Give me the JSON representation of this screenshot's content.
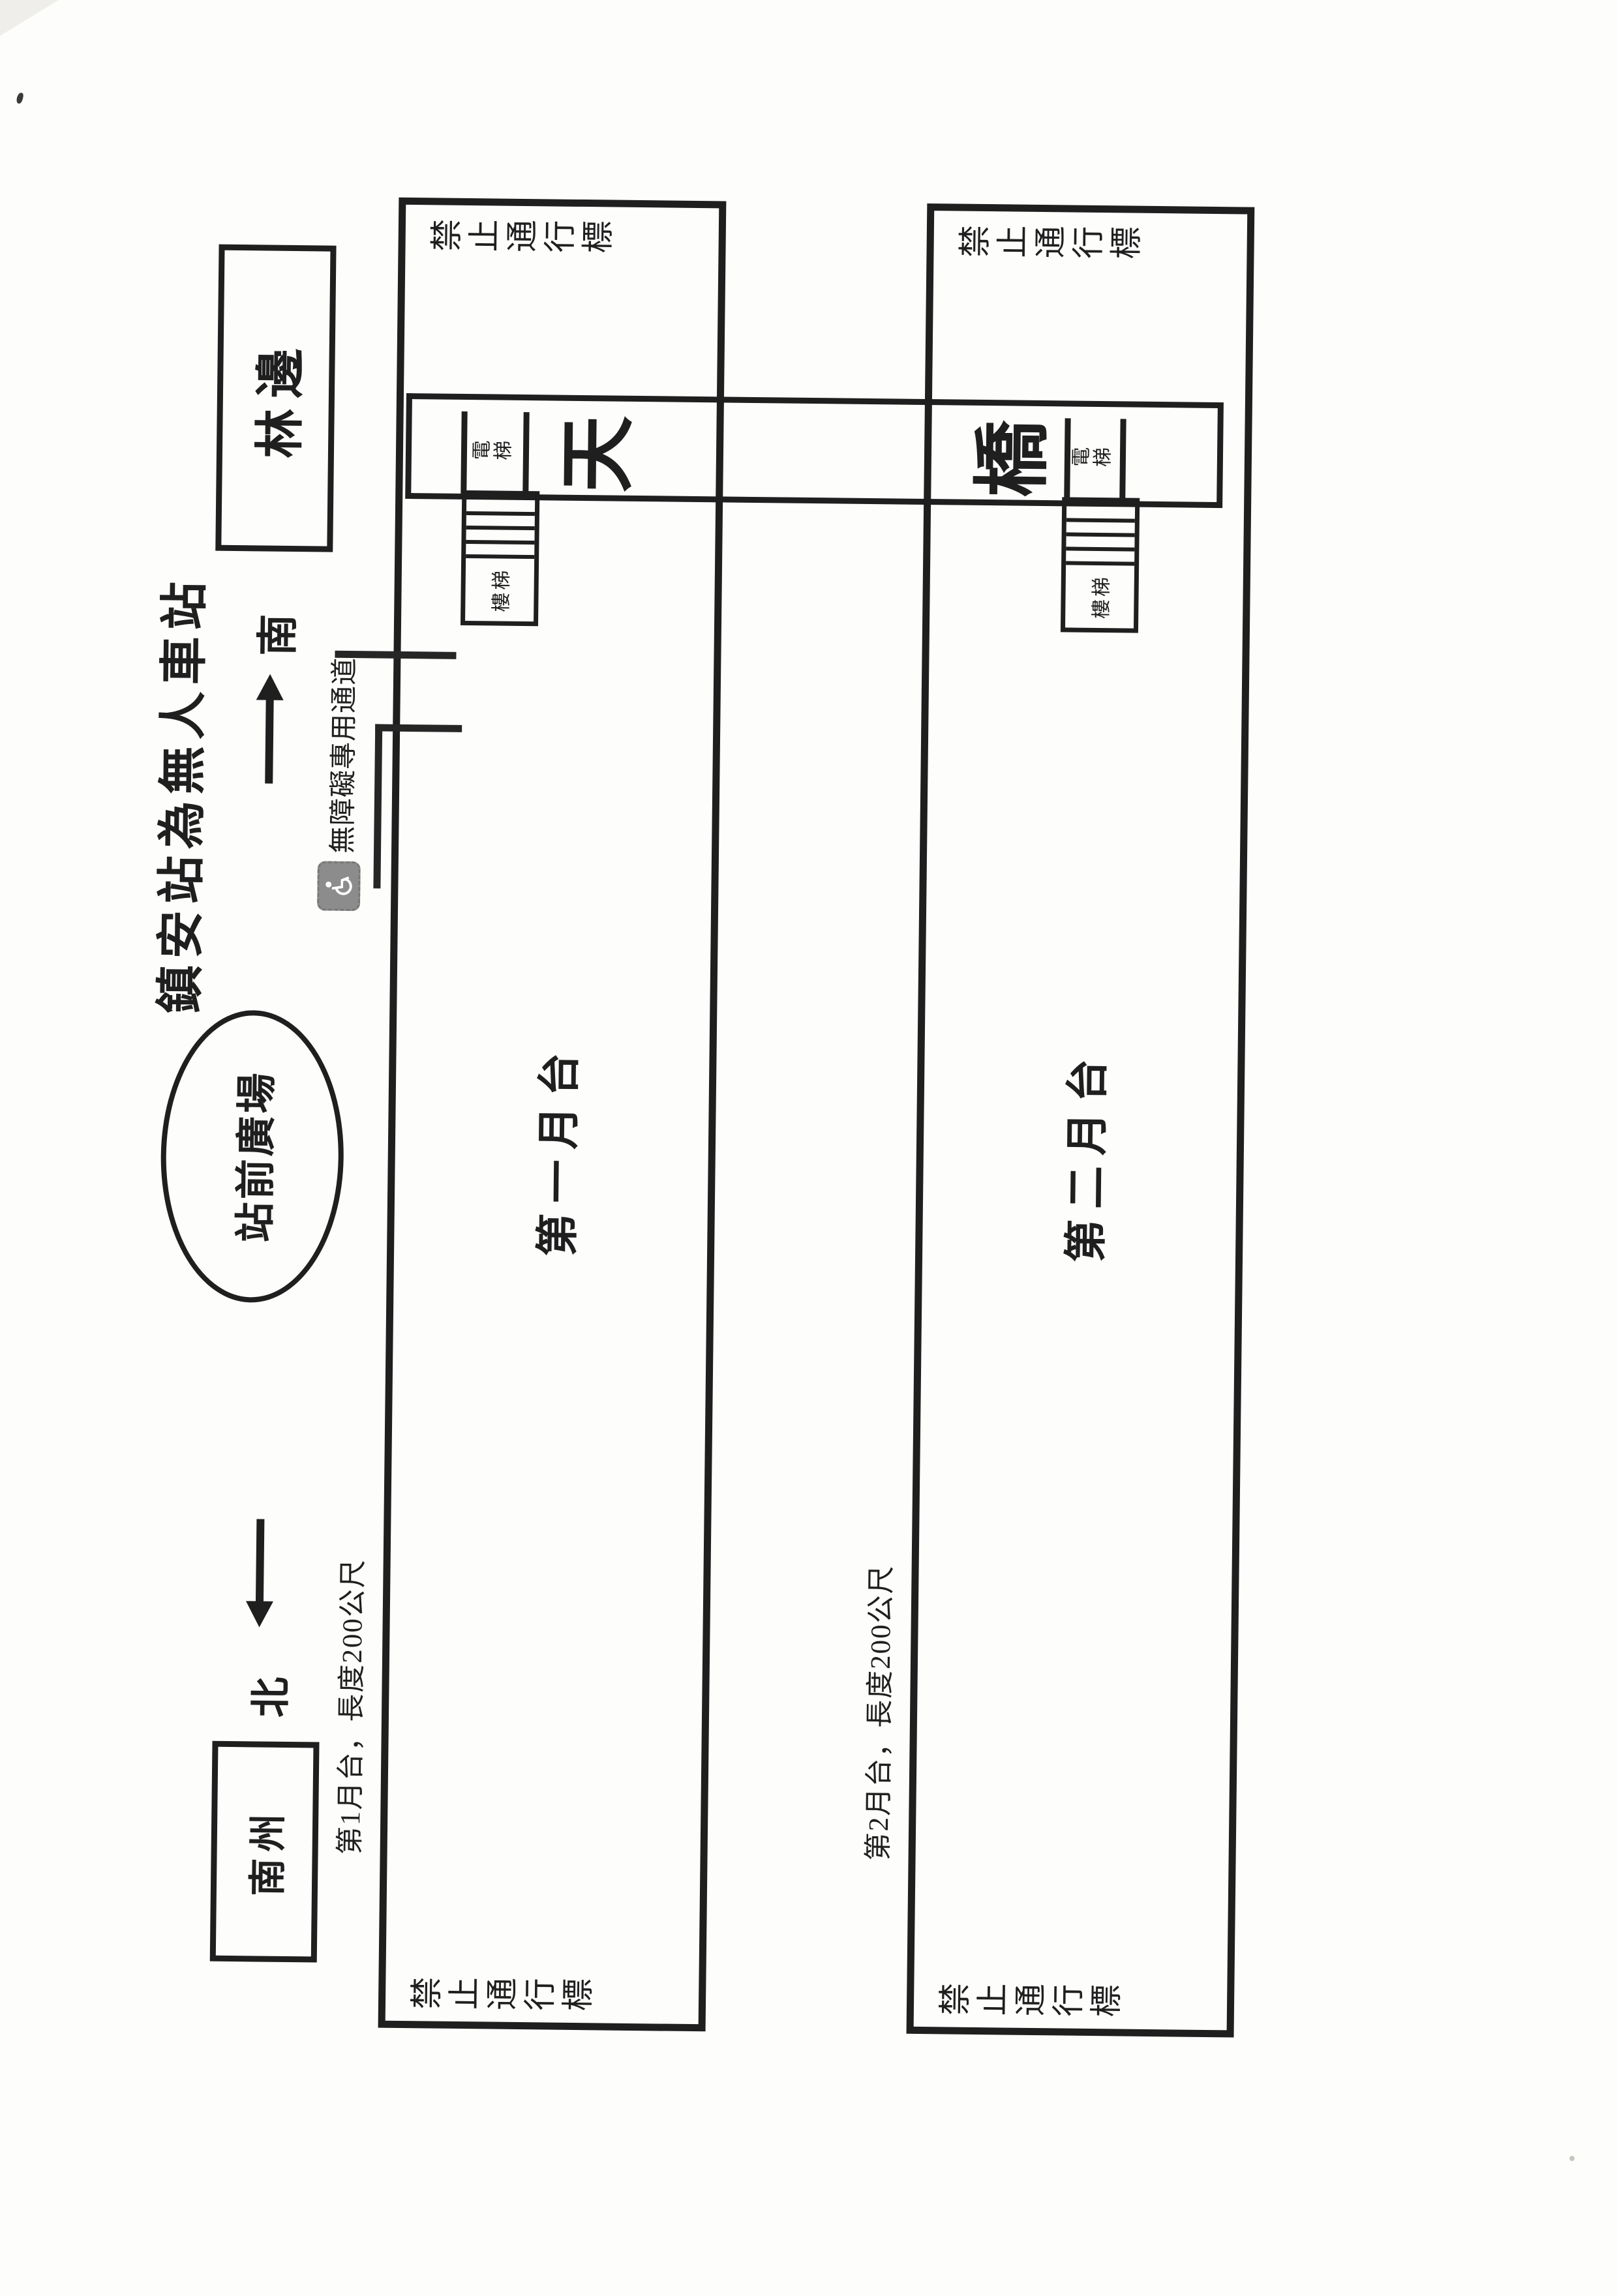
{
  "document": {
    "title": "鎮安站為無人車站"
  },
  "plaza": {
    "label": "站前廣場"
  },
  "adjacent_stations": {
    "south_box": "林邊",
    "north_box": "南州"
  },
  "compass": {
    "south": "南",
    "north": "北"
  },
  "platforms": {
    "p1": {
      "name": "第一月台",
      "note": "第1月台，長度200公尺",
      "no_entry": "禁止通行標"
    },
    "p2": {
      "name": "第二月台",
      "note": "第2月台，長度200公尺",
      "no_entry": "禁止通行標"
    }
  },
  "footbridge": {
    "char_top": "天",
    "char_bottom": "橋",
    "elevator": "電梯",
    "stairs": "樓梯"
  },
  "accessibility": {
    "label": "無障礙專用通道",
    "icon": "wheelchair-icon"
  },
  "colors": {
    "ink": "#1f1f1f",
    "paper": "#fdfdfb",
    "icon_bg": "#8c8c8c"
  }
}
